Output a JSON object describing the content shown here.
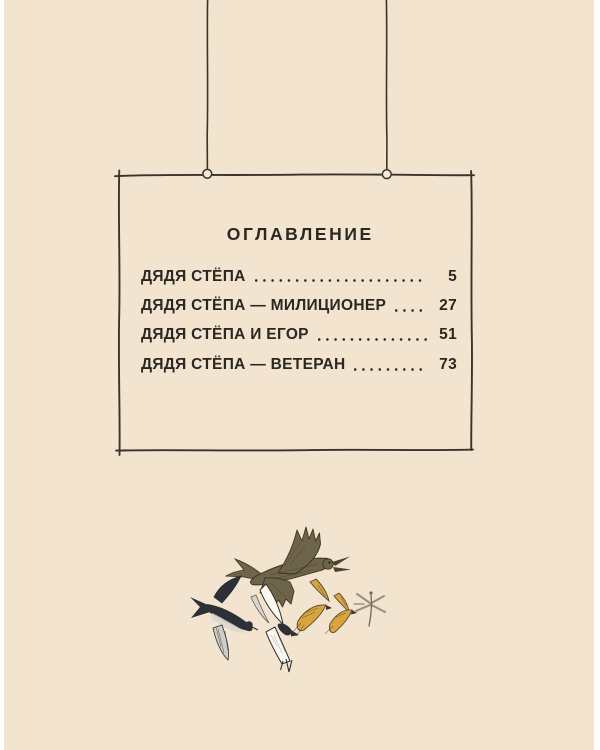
{
  "toc": {
    "title": "ОГЛАВЛЕНИЕ",
    "entries": [
      {
        "label": "ДЯДЯ СТЁПА",
        "page": "5"
      },
      {
        "label": "ДЯДЯ СТЁПА — МИЛИЦИОНЕР",
        "page": "27"
      },
      {
        "label": "ДЯДЯ СТЁПА И ЕГОР",
        "page": "51"
      },
      {
        "label": "ДЯДЯ СТЁПА — ВЕТЕРАН",
        "page": "73"
      }
    ]
  },
  "illustration": {
    "name": "flock-of-flying-birds-and-dragonfly",
    "elements": [
      "brown-hawk",
      "dark-martin",
      "white-swallow",
      "golden-bird-large",
      "golden-bird-small",
      "dragonfly"
    ]
  },
  "colors": {
    "paper": "#f2e4ce",
    "page_edge_white": "#ffffff",
    "text_ink": "#2b2723",
    "frame_ink": "#3a352c",
    "hawk_olive": "#6e6449",
    "martin_dark": "#2d3137",
    "swallow_white": "#fbf8f1",
    "bird_ochre": "#d9a33e"
  }
}
